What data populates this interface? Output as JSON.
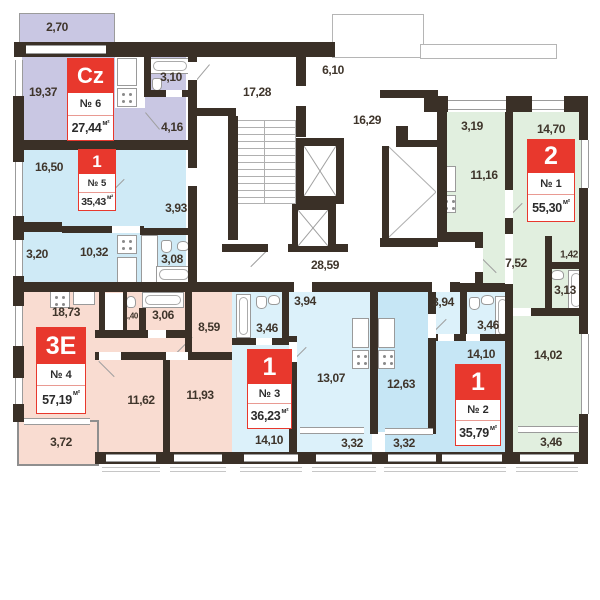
{
  "colors": {
    "wall": "#3a3027",
    "line": "#9b9b9b",
    "text": "#3f352b",
    "tag-red": "#e8382d",
    "tag-border": "#e99a92",
    "apt-cz": "#c9c7e3",
    "apt-1-5": "#cfeaf6",
    "apt-3e": "#f9dcd1",
    "apt-1-3": "#dcf1fa",
    "apt-1-2": "#c6e6f5",
    "apt-2-1": "#e1efdf"
  },
  "unit": "м²",
  "apartments": [
    {
      "code": "Cz",
      "number": "№ 6",
      "area": "27,44",
      "rooms": {
        "balcony": "2,70",
        "living": "19,37",
        "bathroom": "3,10",
        "hallway": "4,16"
      }
    },
    {
      "code": "1",
      "number": "№ 5",
      "area": "35,43",
      "rooms": {
        "living": "16,50",
        "hallway": "3,93",
        "balcony": "3,20",
        "kitchen": "10,32",
        "bathroom": "3,08"
      }
    },
    {
      "code": "3E",
      "number": "№ 4",
      "area": "57,19",
      "rooms": {
        "kitchen_living": "18,73",
        "wc": "1,40",
        "bathroom": "3,06",
        "hallway": "8,59",
        "bedroom1": "11,62",
        "bedroom2": "11,93",
        "balcony": "3,72"
      }
    },
    {
      "code": "1",
      "number": "№ 3",
      "area": "36,23",
      "rooms": {
        "hallway": "3,94",
        "bathroom": "3,46",
        "kitchen": "13,07",
        "living": "14,10",
        "balcony": "3,32"
      }
    },
    {
      "code": "1",
      "number": "№ 2",
      "area": "35,79",
      "rooms": {
        "hallway": "3,94",
        "bathroom": "3,46",
        "kitchen": "12,63",
        "living": "14,10",
        "balcony": "3,32"
      }
    },
    {
      "code": "2",
      "number": "№ 1",
      "area": "55,30",
      "rooms": {
        "hallway": "3,19",
        "bedroom": "14,70",
        "kitchen": "11,16",
        "hall": "7,52",
        "storage": "1,42",
        "bathroom": "3,13",
        "living": "14,02",
        "balcony": "3,46"
      }
    }
  ],
  "common": {
    "stairwell": "17,28",
    "entry": "6,10",
    "corridor_upper": "16,29",
    "corridor_lower": "28,59"
  }
}
